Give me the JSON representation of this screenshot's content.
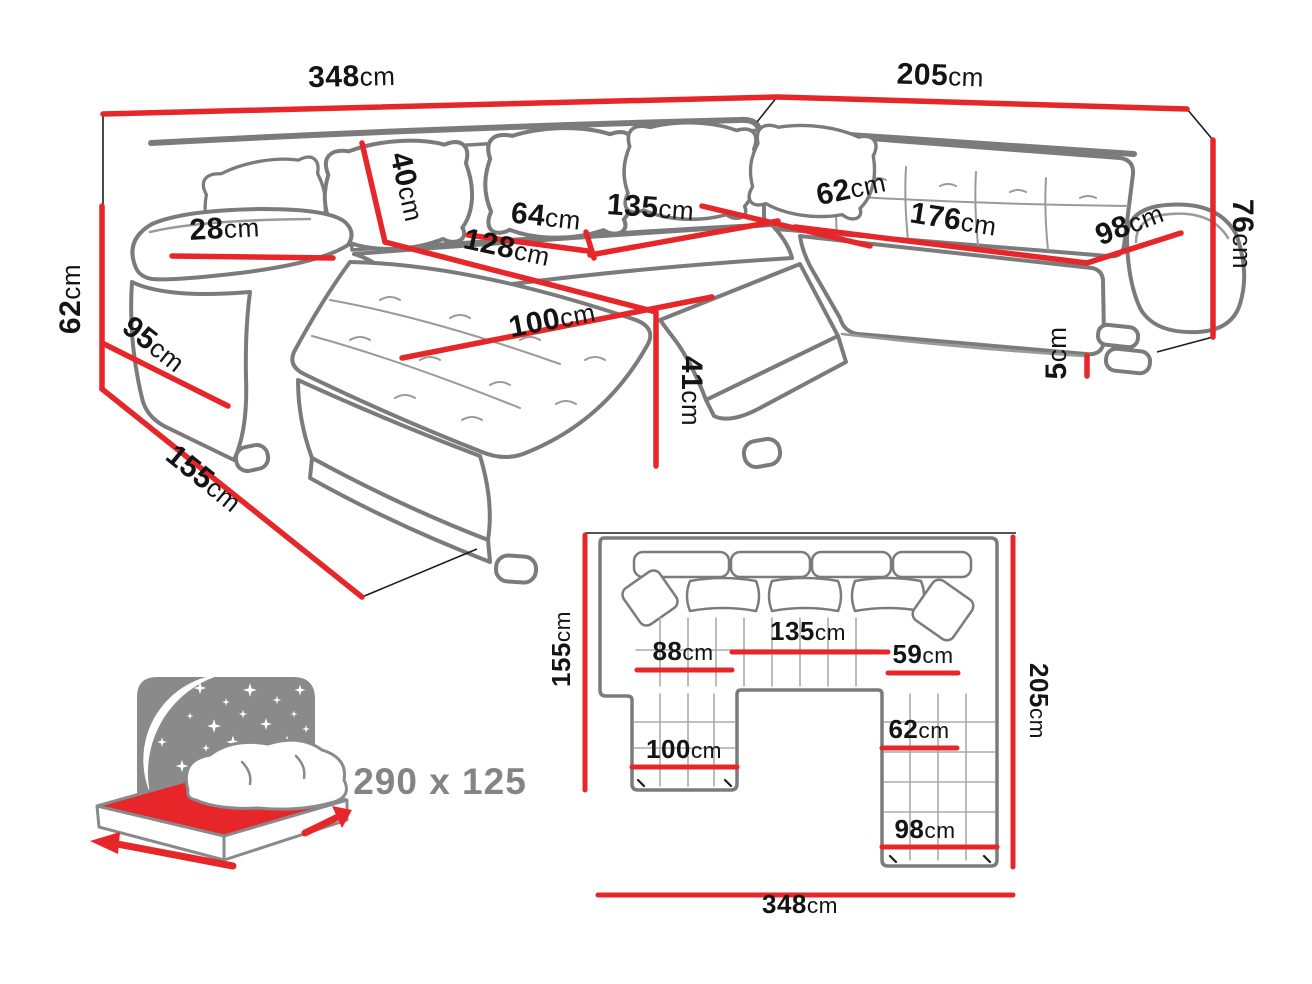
{
  "colors": {
    "dimension_red": "#e62629",
    "sketch_gray": "#7b7b7b",
    "text_black": "#141414",
    "icon_gray": "#8a8a8a"
  },
  "perspective_view": {
    "dims": {
      "total_width": {
        "value": "348",
        "unit": "cm"
      },
      "right_width": {
        "value": "205",
        "unit": "cm"
      },
      "left_height": {
        "value": "62",
        "unit": "cm"
      },
      "left_depth": {
        "value": "155",
        "unit": "cm"
      },
      "armrest_front": {
        "value": "95",
        "unit": "cm"
      },
      "armrest_top": {
        "value": "28",
        "unit": "cm"
      },
      "backrest_height": {
        "value": "40",
        "unit": "cm"
      },
      "chaise_length": {
        "value": "128",
        "unit": "cm"
      },
      "seat_depth_left": {
        "value": "64",
        "unit": "cm"
      },
      "seat_width_middle": {
        "value": "135",
        "unit": "cm"
      },
      "chaise_width": {
        "value": "100",
        "unit": "cm"
      },
      "seat_height": {
        "value": "41",
        "unit": "cm"
      },
      "corner_width": {
        "value": "62",
        "unit": "cm"
      },
      "right_seat_length": {
        "value": "176",
        "unit": "cm"
      },
      "right_seat_depth": {
        "value": "98",
        "unit": "cm"
      },
      "right_height": {
        "value": "76",
        "unit": "cm"
      },
      "leg_height": {
        "value": "5",
        "unit": "cm"
      }
    }
  },
  "top_view": {
    "dims": {
      "left_depth": {
        "value": "155",
        "unit": "cm"
      },
      "middle_seat": {
        "value": "135",
        "unit": "cm"
      },
      "left_seat": {
        "value": "88",
        "unit": "cm"
      },
      "corner_seat": {
        "value": "59",
        "unit": "cm"
      },
      "right_depth": {
        "value": "205",
        "unit": "cm"
      },
      "chaise_width": {
        "value": "100",
        "unit": "cm"
      },
      "right_seat_inner": {
        "value": "62",
        "unit": "cm"
      },
      "right_seat_width": {
        "value": "98",
        "unit": "cm"
      },
      "total_width": {
        "value": "348",
        "unit": "cm"
      }
    }
  },
  "sleeping_area": {
    "size_label": "290 x 125"
  }
}
